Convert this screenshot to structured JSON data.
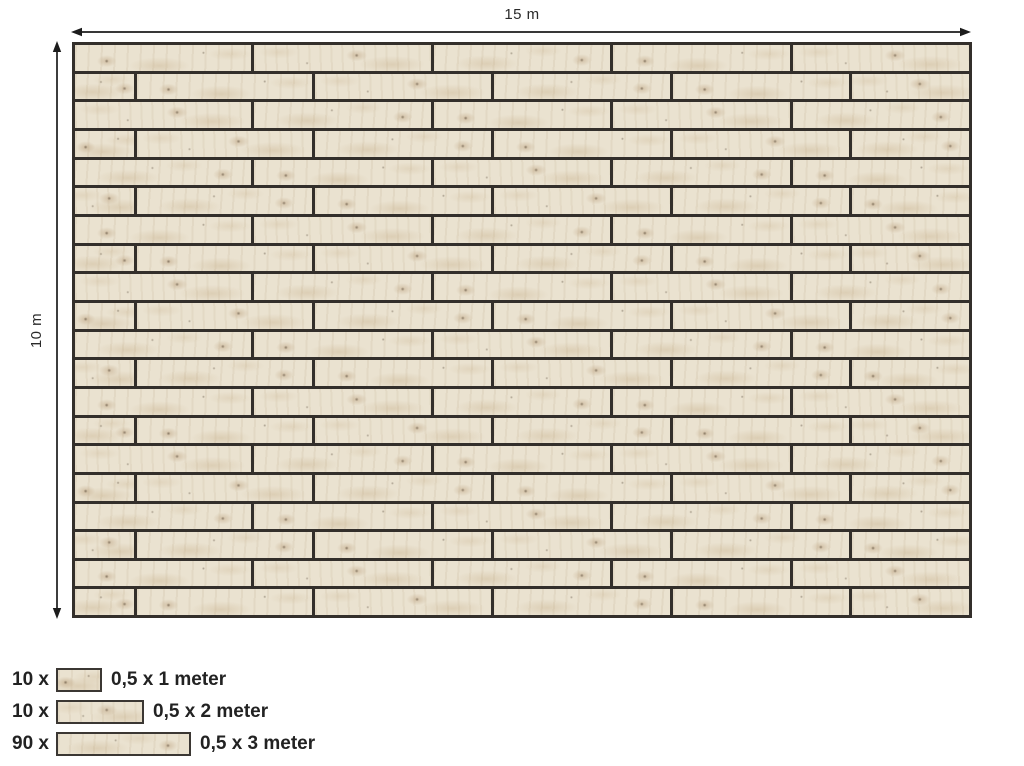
{
  "diagram": {
    "title": "deck-plank-layout",
    "width_label": "15 m",
    "height_label": "10 m",
    "floor": {
      "rows": 20,
      "row_pattern_odd": [
        3,
        3,
        3,
        3,
        3
      ],
      "row_pattern_even": [
        1,
        3,
        3,
        3,
        3,
        2
      ]
    }
  },
  "legend": {
    "items": [
      {
        "count": "10 x",
        "label": "0,5 x 1 meter",
        "meters": 1
      },
      {
        "count": "10 x",
        "label": "0,5 x 2 meter",
        "meters": 2
      },
      {
        "count": "90 x",
        "label": "0,5 x 3 meter",
        "meters": 3
      }
    ]
  },
  "colors": {
    "plank_border": "#332f2b",
    "wood_base": "#eae2d0",
    "text": "#262626",
    "arrow": "#1c1c1c"
  }
}
